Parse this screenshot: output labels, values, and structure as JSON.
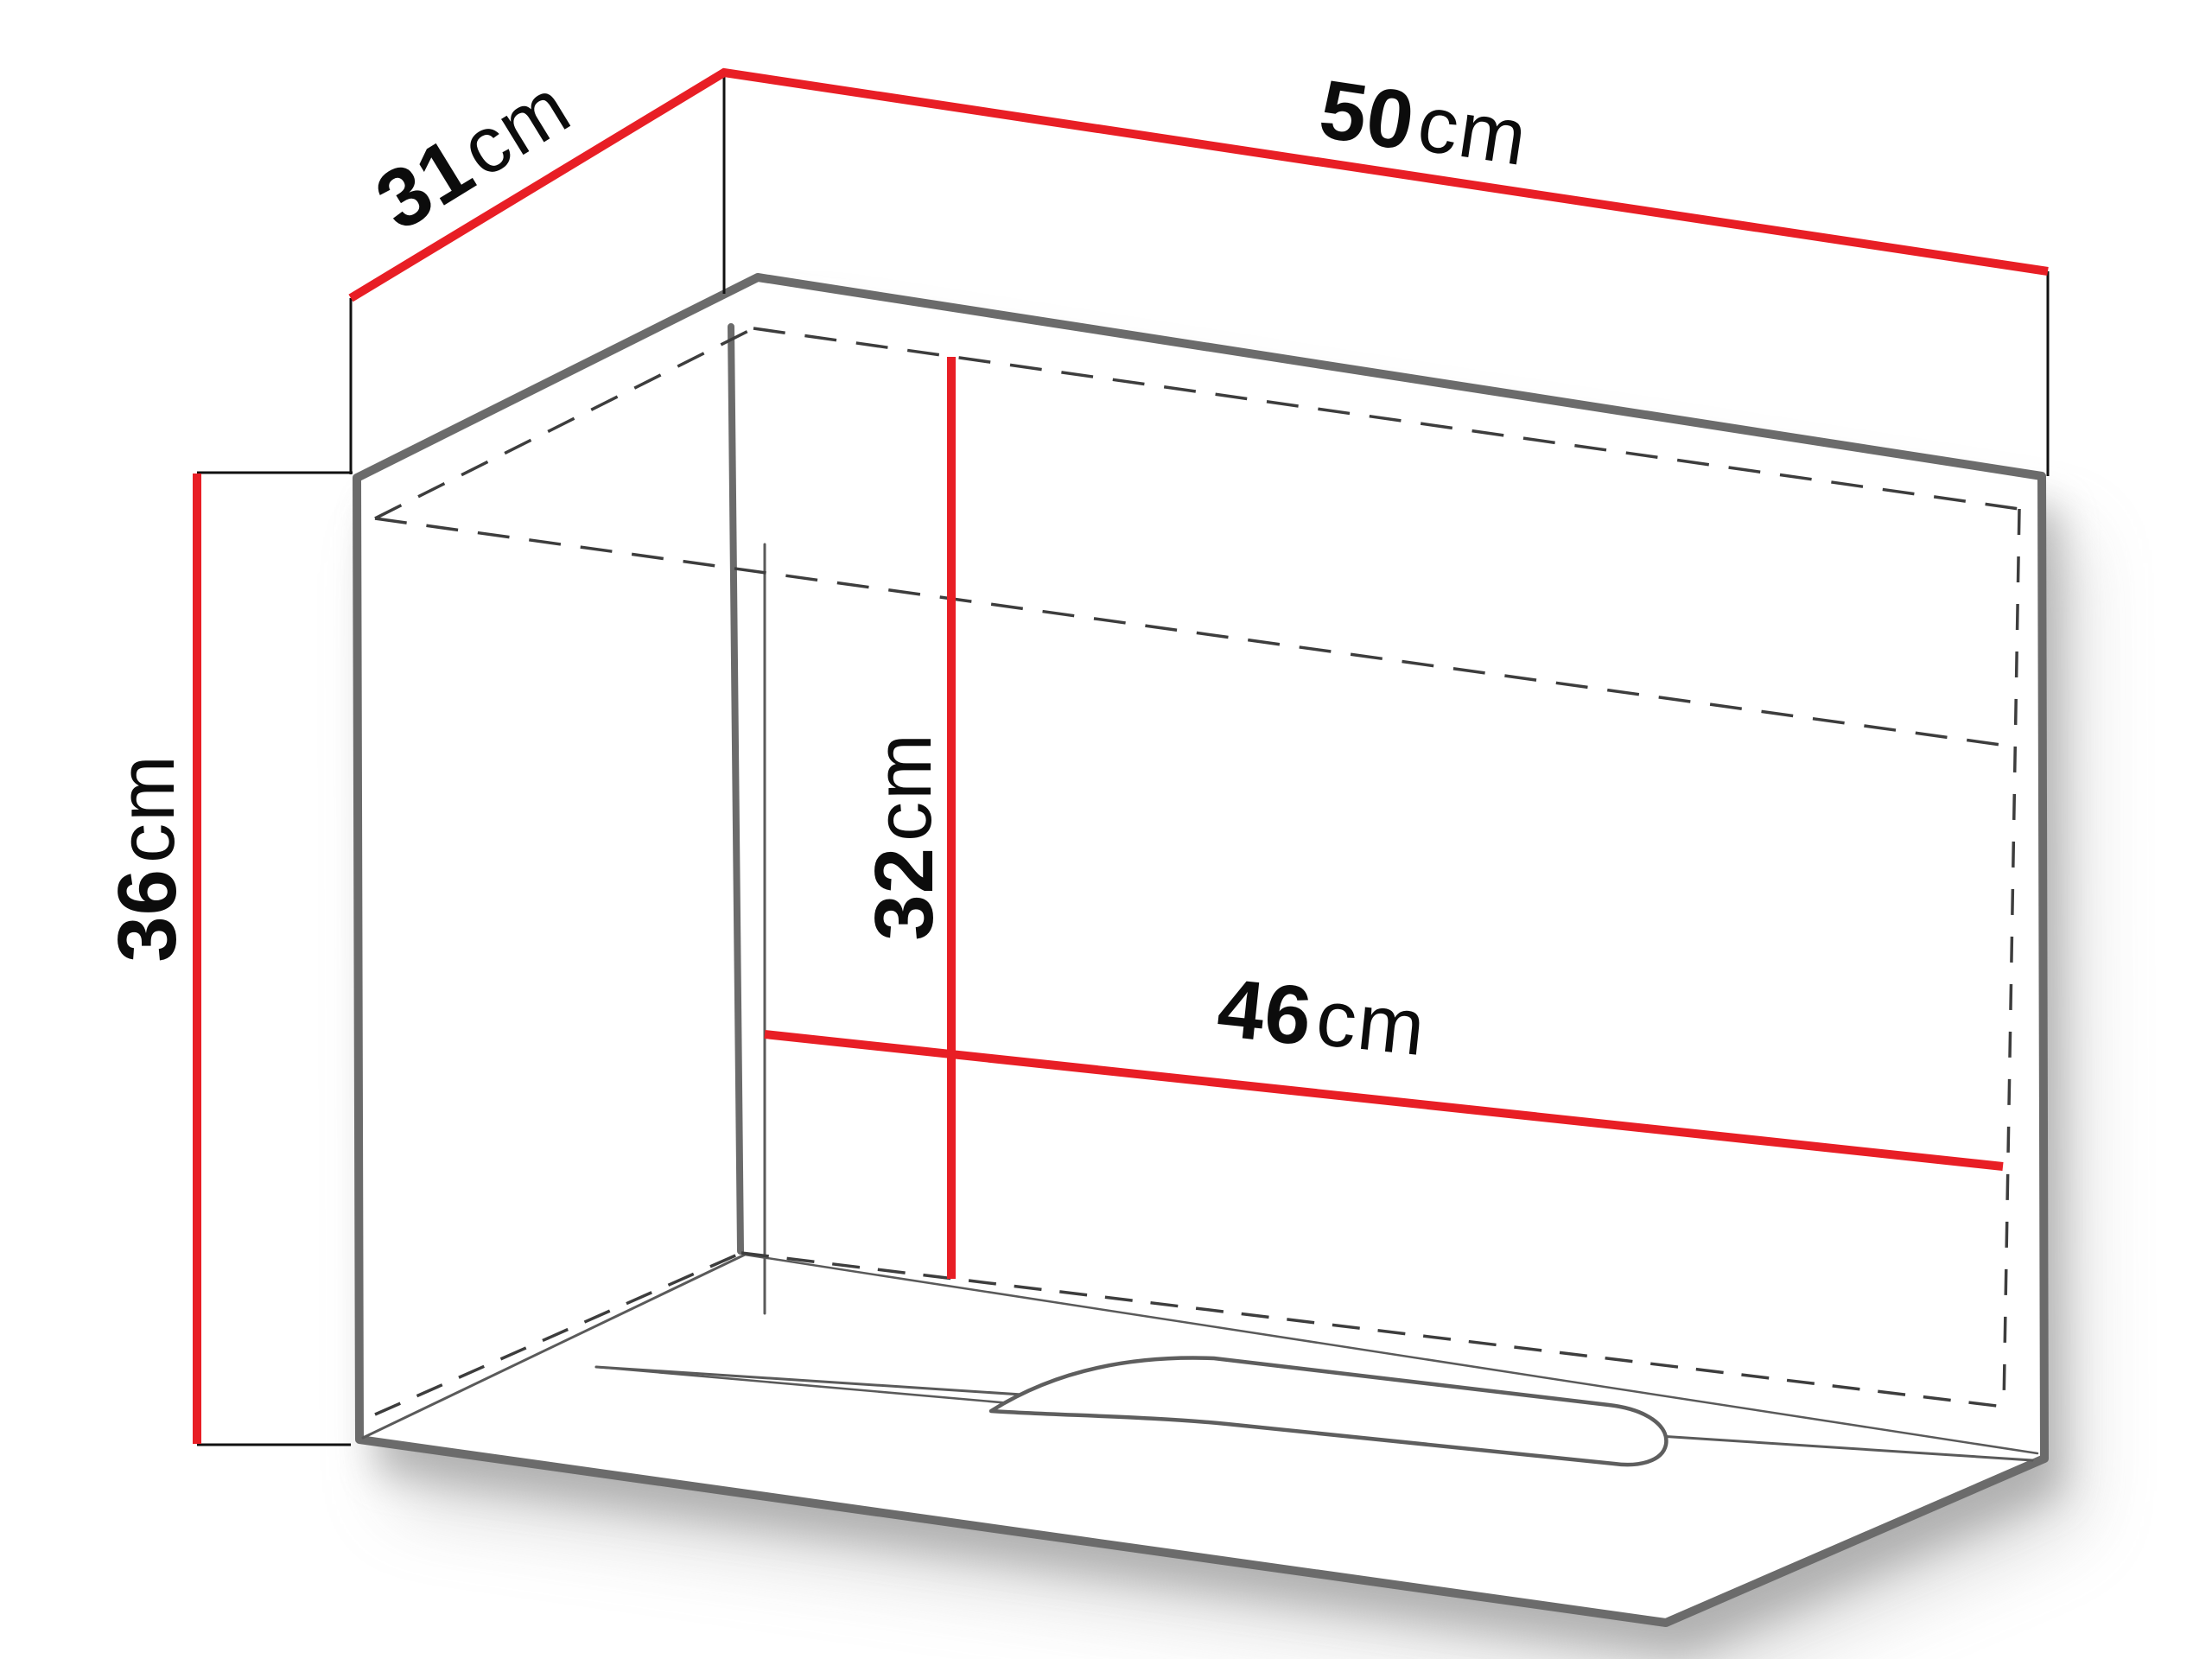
{
  "diagram": {
    "title": "cabinet-dimension-drawing",
    "type": "furniture-technical-diagram",
    "colors": {
      "dimension_line": "#e81e25",
      "outline": "#6b6b6b",
      "hidden_edge": "#3d3d3d",
      "text": "#0c0c0c",
      "background": "#ffffff"
    },
    "dimensions": {
      "width": {
        "number": "50",
        "unit": "cm",
        "meaning": "outer width"
      },
      "depth": {
        "number": "31",
        "unit": "cm",
        "meaning": "outer depth"
      },
      "height": {
        "number": "36",
        "unit": "cm",
        "meaning": "outer height"
      },
      "inner_height": {
        "number": "32",
        "unit": "cm",
        "meaning": "interior height"
      },
      "inner_width": {
        "number": "46",
        "unit": "cm",
        "meaning": "interior width"
      }
    }
  }
}
